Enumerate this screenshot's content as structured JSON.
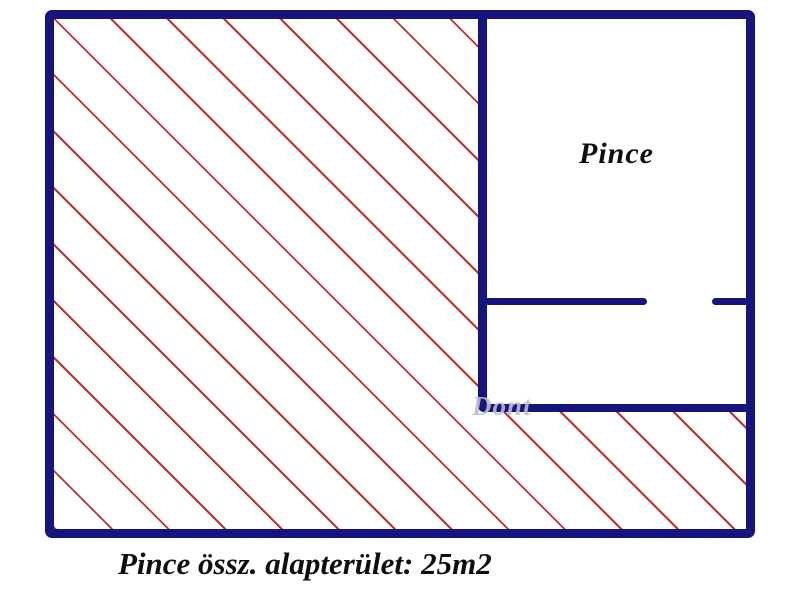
{
  "plan": {
    "room_label": "Pince",
    "caption": "Pince össz. alapterület: 25m2",
    "total_area": "25m2",
    "watermark": "Dont"
  },
  "colors": {
    "wall": "#15157d",
    "hatch_line": "#c13030",
    "label_text": "#0e0e0e",
    "watermark_text": "#bcbecd",
    "background": "#ffffff"
  }
}
